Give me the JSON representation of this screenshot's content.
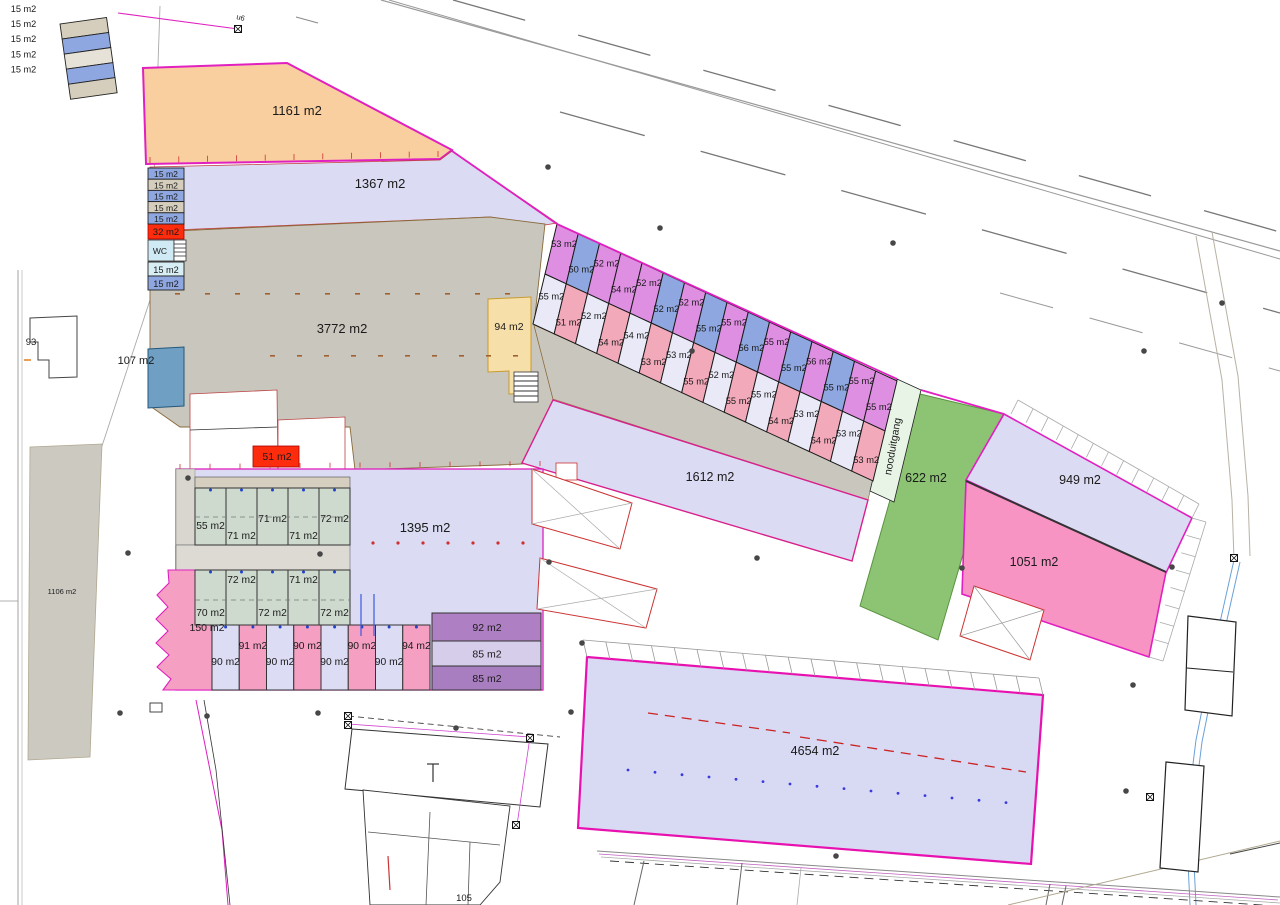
{
  "plan": {
    "areas": {
      "a1161": "1161 m2",
      "a1367": "1367 m2",
      "a3772": "3772 m2",
      "a107": "107 m2",
      "a94": "94 m2",
      "a51": "51 m2",
      "a32": "32 m2",
      "wc": "WC",
      "a1612": "1612 m2",
      "a622": "622 m2",
      "a949": "949 m2",
      "a1051": "1051 m2",
      "a1395": "1395 m2",
      "a4654": "4654 m2",
      "a1106": "1106 m2",
      "a150": "150 m2",
      "b93": "93",
      "b105": "105",
      "road_marker": "u6",
      "exit_label": "nooduitgang"
    },
    "outside_stack": [
      "15 m2",
      "15 m2",
      "15 m2",
      "15 m2",
      "15 m2"
    ],
    "inside_stack": [
      "15 m2",
      "15 m2",
      "15 m2",
      "15 m2",
      "15 m2"
    ],
    "wc_stack": [
      "15 m2",
      "15 m2"
    ],
    "strip": {
      "top": [
        {
          "t": "53 m2",
          "c": "V"
        },
        {
          "t": "50 m2",
          "c": "B"
        },
        {
          "t": "52 m2",
          "c": "V"
        },
        {
          "t": "54 m2",
          "c": "V"
        },
        {
          "t": "52 m2",
          "c": "V"
        },
        {
          "t": "52 m2",
          "c": "B"
        },
        {
          "t": "52 m2",
          "c": "V"
        },
        {
          "t": "55 m2",
          "c": "B"
        },
        {
          "t": "55 m2",
          "c": "V"
        },
        {
          "t": "56 m2",
          "c": "B"
        },
        {
          "t": "55 m2",
          "c": "V"
        },
        {
          "t": "55 m2",
          "c": "B"
        },
        {
          "t": "56 m2",
          "c": "V"
        },
        {
          "t": "55 m2",
          "c": "B"
        },
        {
          "t": "55 m2",
          "c": "V"
        },
        {
          "t": "55 m2",
          "c": "V"
        }
      ],
      "bottom": [
        {
          "t": "55 m2",
          "c": "L"
        },
        {
          "t": "51 m2",
          "c": "P"
        },
        {
          "t": "52 m2",
          "c": "L"
        },
        {
          "t": "54 m2",
          "c": "P"
        },
        {
          "t": "54 m2",
          "c": "L"
        },
        {
          "t": "53 m2",
          "c": "P"
        },
        {
          "t": "53 m2",
          "c": "L"
        },
        {
          "t": "55 m2",
          "c": "P"
        },
        {
          "t": "52 m2",
          "c": "L"
        },
        {
          "t": "55 m2",
          "c": "P"
        },
        {
          "t": "55 m2",
          "c": "L"
        },
        {
          "t": "54 m2",
          "c": "P"
        },
        {
          "t": "53 m2",
          "c": "L"
        },
        {
          "t": "54 m2",
          "c": "P"
        },
        {
          "t": "53 m2",
          "c": "L"
        },
        {
          "t": "53 m2",
          "c": "P"
        }
      ]
    },
    "block": {
      "row1": [
        {
          "t": "55 m2",
          "p": "mid"
        },
        {
          "t": "71 m2",
          "p": "low"
        },
        {
          "t": "71 m2",
          "p": "high"
        },
        {
          "t": "71 m2",
          "p": "low"
        },
        {
          "t": "72 m2",
          "p": "high"
        }
      ],
      "row2": [
        {
          "t": "70 m2",
          "p": "low"
        },
        {
          "t": "72 m2",
          "p": "high"
        },
        {
          "t": "72 m2",
          "p": "low"
        },
        {
          "t": "71 m2",
          "p": "high"
        },
        {
          "t": "72 m2",
          "p": "low"
        }
      ],
      "row3": [
        {
          "t": "90 m2",
          "p": "low"
        },
        {
          "t": "91 m2",
          "p": "high"
        },
        {
          "t": "90 m2",
          "p": "low"
        },
        {
          "t": "90 m2",
          "p": "high"
        },
        {
          "t": "90 m2",
          "p": "low"
        },
        {
          "t": "90 m2",
          "p": "high"
        },
        {
          "t": "90 m2",
          "p": "low"
        },
        {
          "t": "94 m2",
          "p": "high"
        }
      ],
      "stack": [
        "92 m2",
        "85 m2",
        "85 m2"
      ]
    },
    "colors": {
      "magenta": "#e020c0",
      "violet": "#df8fe2",
      "blue": "#8fa7e0",
      "pale": "#e9e9f7",
      "pink": "#f2a9b9",
      "cellGreen": "#cfdacf",
      "cellPink": "#f59fc3",
      "cellLav": "#dcdcf4",
      "green": "#8cc474",
      "purple": "#ae7fc2",
      "purpleLight": "#d6cdeb",
      "purpleDark": "#a97ec0",
      "orange": "#f9cf9f",
      "lavender": "#dbdbf3",
      "gray": "#c9c6bd",
      "steelBlue": "#6f9fc3",
      "red": "#fd2c0c",
      "yellow": "#f7dfa9",
      "bigPink": "#f894c4",
      "tan": "#d5cebc",
      "wcBlue": "#cfeaf4",
      "paleGreenExit": "#e8f5e6"
    }
  }
}
